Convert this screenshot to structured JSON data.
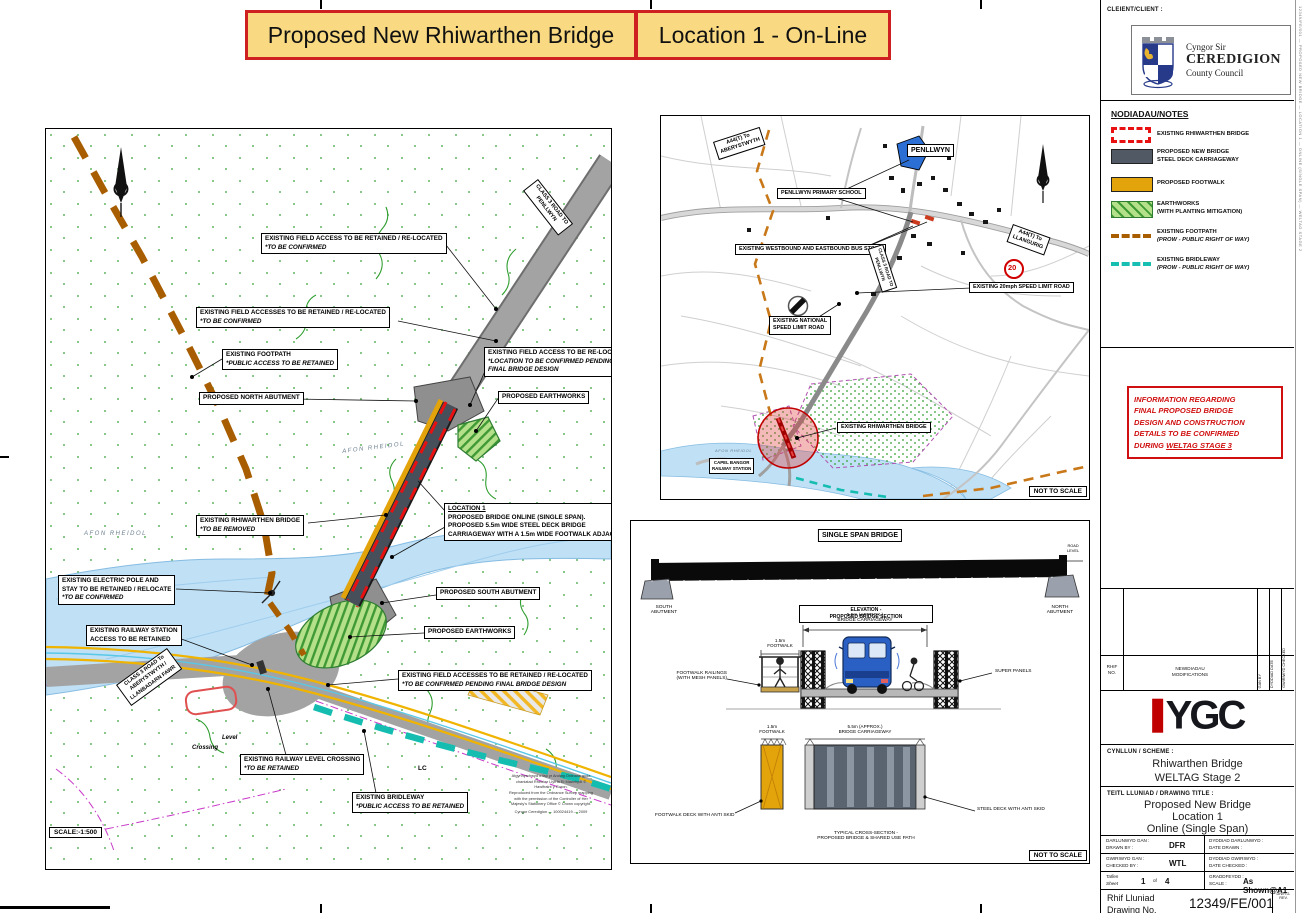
{
  "banner": {
    "title": "Proposed New Rhiwarthen Bridge",
    "subtitle": "Location 1 - On-Line"
  },
  "client": {
    "label": "CLEIENT/CLIENT :",
    "org1": "Cyngor Sir",
    "org2": "CEREDIGION",
    "org3": "County Council"
  },
  "notes": {
    "heading": "NODIADAU/NOTES",
    "items": [
      {
        "label": "EXISTING RHIWARTHEN BRIDGE",
        "sub": ""
      },
      {
        "label": "PROPOSED NEW BRIDGE",
        "sub": "STEEL DECK CARRIAGEWAY"
      },
      {
        "label": "PROPOSED FOOTWALK",
        "sub": ""
      },
      {
        "label": "EARTHWORKS",
        "sub": "(WITH PLANTING MITIGATION)"
      },
      {
        "label": "EXISTING FOOTPATH",
        "sub": "(PROW - PUBLIC RIGHT OF WAY)"
      },
      {
        "label": "EXISTING BRIDLEWAY",
        "sub": "(PROW - PUBLIC RIGHT OF WAY)"
      }
    ]
  },
  "info_box": {
    "l1": "INFORMATION REGARDING",
    "l2": "FINAL PROPOSED BRIDGE",
    "l3": "DESIGN AND CONSTRUCTION",
    "l4": "DETAILS TO BE CONFIRMED",
    "during": "DURING ",
    "emphasis": "WELTAG STAGE 3"
  },
  "revisions": {
    "col_no1": "RHIF",
    "col_no2": "NO.",
    "mod1": "NEWIDIADAU",
    "mod2": "MODIFICATIONS",
    "by1": "GAN",
    "by2": "BY",
    "date1": "DYDDIAD",
    "date2": "DATE",
    "chk1": "GWIRIWYD",
    "chk2": "CHECKED"
  },
  "ygc": {
    "text": "YGC"
  },
  "scheme": {
    "label": "CYNLLUN / SCHEME :",
    "line1": "Rhiwarthen Bridge",
    "line2": "WELTAG Stage 2"
  },
  "drawing_title": {
    "label": "TEITL LLUNIAD / DRAWING TITLE :",
    "line1": "Proposed New Bridge",
    "line2": "Location 1",
    "line3": "Online (Single Span)"
  },
  "tb": {
    "drawn_cy": "DARLUNWYD GAN :",
    "drawn_en": "DRAWN BY :",
    "drawn_val": "DFR",
    "date_drawn_cy": "DYDDIAD DARLUNWYD :",
    "date_drawn_en": "DATE DRAWN :",
    "checked_cy": "GWIRIWYD GAN :",
    "checked_en": "CHECKED BY :",
    "checked_val": "WTL",
    "date_checked_cy": "DYDDIAD GWIRIWYD :",
    "date_checked_en": "DATE CHECKED :",
    "sheet_cy": "Taflen",
    "sheet_en": "Sheet",
    "sheet_no": "1",
    "sheet_of": "of",
    "sheet_total": "4",
    "scale_cy": "GRADDFEYDD :",
    "scale_en": "SCALE :",
    "scale_val": "As Shown@A1",
    "dwg_cy": "Rhif Lluniad",
    "dwg_en": "Drawing No.",
    "dwg_no": "12349/FE/001",
    "rev_cy": "DIWYG.",
    "rev_en": "REV."
  },
  "edge_stamp": "12349/FE/001 — PROPOSED NEW BRIDGE — LOCATION 1 — ONLINE (SINGLE SPAN) — WELTAG STAGE 2",
  "site_plan": {
    "scale": "SCALE:-1:500",
    "river1": "AFON RHEIDOL",
    "river2": "AFON RHEIDOL",
    "level": "Level",
    "crossing": "Crossing",
    "lc": "LC",
    "labels": {
      "fa_ne": [
        "EXISTING FIELD ACCESS TO BE RETAINED / RE-LOCATED",
        "*TO BE CONFIRMED"
      ],
      "fa_nw": [
        "EXISTING FIELD ACCESSES TO BE RETAINED / RE-LOCATED",
        "*TO BE CONFIRMED"
      ],
      "footpath": [
        "EXISTING FOOTPATH",
        "*PUBLIC ACCESS TO BE RETAINED"
      ],
      "north_ab": [
        "PROPOSED NORTH ABUTMENT"
      ],
      "fa_reloc": [
        "EXISTING FIELD ACCESS TO BE RE-LOCATED",
        "*LOCATION TO BE CONFIRMED PENDING",
        "FINAL BRIDGE DESIGN"
      ],
      "earth_n": [
        "PROPOSED EARTHWORKS"
      ],
      "ex_bridge": [
        "EXISTING RHIWARTHEN BRIDGE",
        "*TO BE REMOVED"
      ],
      "loc1": [
        "LOCATION 1",
        "PROPOSED BRIDGE ONLINE (SINGLE SPAN).",
        "PROPOSED 5.5m WIDE STEEL DECK BRIDGE",
        "CARRIAGEWAY WITH A 1.5m WIDE FOOTWALK ADJACENT."
      ],
      "elec": [
        "EXISTING ELECTRIC POLE AND",
        "STAY TO BE RETAINED / RELOCATE",
        "*TO BE CONFIRMED"
      ],
      "station": [
        "EXISTING RAILWAY STATION",
        "ACCESS TO BE RETAINED"
      ],
      "south_ab": [
        "PROPOSED SOUTH ABUTMENT"
      ],
      "earth_s": [
        "PROPOSED EARTHWORKS"
      ],
      "fa_s": [
        "EXISTING FIELD ACCESSES TO BE RETAINED / RE-LOCATED",
        "*TO BE CONFIRMED PENDING FINAL BRIDGE DESIGN"
      ],
      "levelx": [
        "EXISTING RAILWAY LEVEL CROSSING",
        "*TO BE RETAINED"
      ],
      "bridle": [
        "EXISTING BRIDLEWAY",
        "*PUBLIC ACCESS TO BE RETAINED"
      ],
      "class3_sw": [
        "CLASS 3 ROAD To",
        "ABERYSTWYTH /",
        "LLANBADARN FAWR"
      ],
      "class3_ne": [
        "CLASS 3 ROAD TO",
        "PENLLWYN"
      ]
    },
    "legal": [
      "Atgynhyrchwyd o fap yr Arolwg Ordnans gyda",
      "chaniatad Rheolwr Llyfrfa Ei Mawrhydi ©",
      "Hawlfraint y Goron.",
      "Reproduced from the Ordnance Survey mapping",
      "with the permission of the Controller of Her",
      "Majesty's Stationery Office © Crown copyright.",
      "Cyngor Ceredigion — 100024419 — 2009"
    ]
  },
  "location_plan": {
    "speed20": "20",
    "not_to_scale": "NOT TO SCALE",
    "labels": {
      "a44_ab": [
        "A44(T) To",
        "ABERYSTWYTH"
      ],
      "penllwyn": [
        "PENLLWYN"
      ],
      "school": [
        "PENLLWYN PRIMARY SCHOOL"
      ],
      "bus": [
        "EXISTING WESTBOUND AND EASTBOUND BUS STOPS"
      ],
      "speed20": [
        "EXISTING 20mph SPEED LIMIT ROAD"
      ],
      "national": [
        "EXISTING NATIONAL",
        "SPEED LIMIT ROAD"
      ],
      "class3": [
        "CLASS 3 ROAD TO",
        "PENLLWYN"
      ],
      "a44_ll": [
        "A44(T) To",
        "LLANGURIG"
      ],
      "ex_bridge": [
        "EXISTING RHIWARTHEN BRIDGE"
      ],
      "afon": [
        "AFON RHEIDOL"
      ],
      "capel": [
        "CAPEL BANGOR",
        "RAILWAY STATION"
      ]
    }
  },
  "bridge_panel": {
    "heading": "SINGLE SPAN BRIDGE",
    "south1": "SOUTH",
    "south2": "ABUTMENT",
    "north1": "NORTH",
    "north2": "ABUTMENT",
    "road_level1": "ROAD",
    "road_level2": "LEVEL",
    "elev1": "ELEVATION -",
    "elev2": "PROPOSED BRIDGE SECTION",
    "dim55_1": "5.5m (APPROX.)",
    "dim55_2": "BRIDGE CARRIAGEWAY",
    "dim15_1": "1.5m",
    "dim15_2": "FOOTWALK",
    "railings1": "FOOTWALK RAILINGS",
    "railings2": "(WITH MESH PANELS)",
    "super_panels": "SUPER PANELS",
    "footwalk_deck": "FOOTWALK DECK WITH ANTI SKID",
    "steel_deck": "STEEL DECK WITH ANTI SKID",
    "sect1": "TYPICAL CROSS-SECTION -",
    "sect2": "PROPOSED BRIDGE & SHARED USE PATH",
    "not_to_scale": "NOT TO SCALE"
  }
}
